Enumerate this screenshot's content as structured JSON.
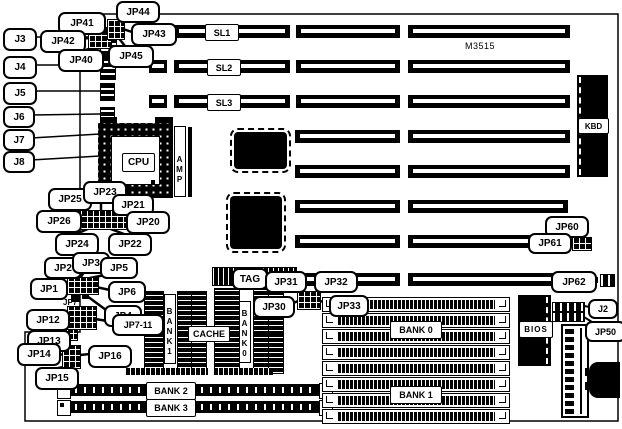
{
  "board": {
    "model": "M3515",
    "cpu_label": "CPU",
    "socket_brand": "AMP",
    "kbd_chip_label": "KBD",
    "bios_chip_label": "BIOS",
    "ink_color": "#000000",
    "background_color": "#ffffff"
  },
  "slot_labels": [
    "SL1",
    "SL2",
    "SL3"
  ],
  "memory": {
    "bank0": "BANK 0",
    "bank1": "BANK 1",
    "bank2": "BANK 2",
    "bank3": "BANK 3",
    "cache": "CACHE",
    "bank0_col": "BANK0",
    "bank1_col": "BANK1"
  },
  "callouts": {
    "j2": "J2",
    "j3": "J3",
    "j4": "J4",
    "j5": "J5",
    "j6": "J6",
    "j7": "J7",
    "j8": "J8",
    "jp40": "JP40",
    "jp41": "JP41",
    "jp42": "JP42",
    "jp43": "JP43",
    "jp44": "JP44",
    "jp45": "JP45",
    "jp20": "JP20",
    "jp21": "JP21",
    "jp22": "JP22",
    "jp23": "JP23",
    "jp24": "JP24",
    "jp25": "JP25",
    "jp26": "JP26",
    "jp1": "JP1",
    "jp2": "JP2",
    "jp3": "JP3",
    "jp4": "JP4",
    "jp5": "JP5",
    "jp6": "JP6",
    "jp7": "JP7",
    "jp7_11": "JP7-11",
    "jp12": "JP12",
    "jp13": "JP13",
    "jp14": "JP14",
    "jp15": "JP15",
    "jp16": "JP16",
    "tag": "TAG",
    "jp30": "JP30",
    "jp31": "JP31",
    "jp32": "JP32",
    "jp33": "JP33",
    "jp50": "JP50",
    "jp60": "JP60",
    "jp61": "JP61",
    "jp62": "JP62"
  }
}
